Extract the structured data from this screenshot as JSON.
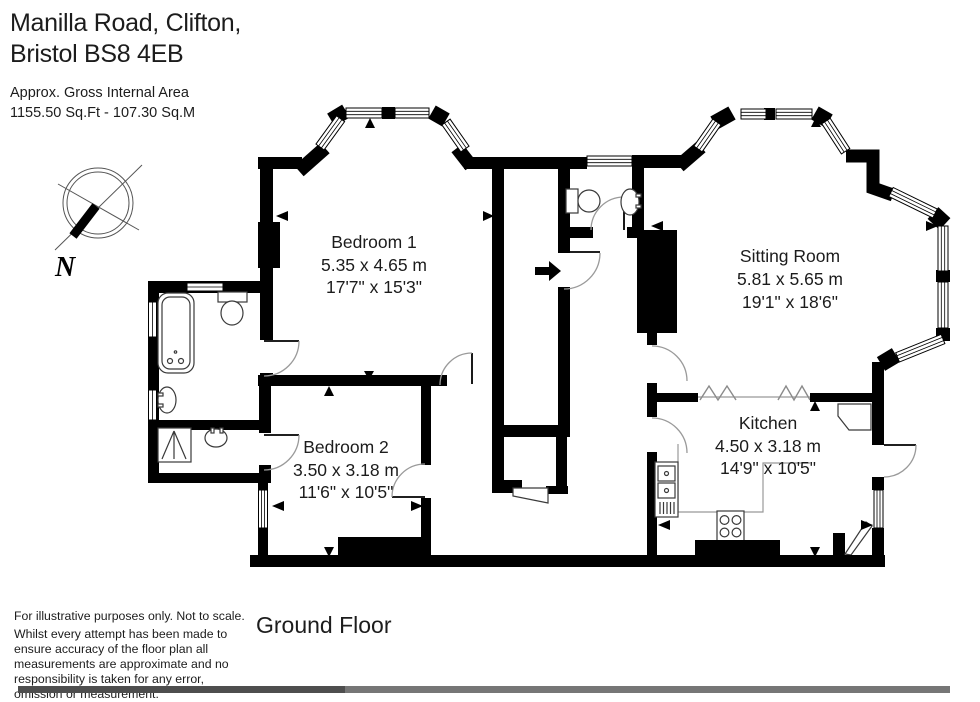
{
  "header": {
    "address_line1": "Manilla Road, Clifton,",
    "address_line2": "Bristol BS8 4EB",
    "area_label": "Approx. Gross Internal Area",
    "area_value": "1155.50 Sq.Ft - 107.30 Sq.M"
  },
  "compass": {
    "north_label": "N"
  },
  "rooms": {
    "bedroom1": {
      "name": "Bedroom 1",
      "metric": "5.35 x 4.65 m",
      "imperial": "17'7\" x 15'3\""
    },
    "bedroom2": {
      "name": "Bedroom 2",
      "metric": "3.50 x 3.18 m",
      "imperial": "11'6\" x 10'5\""
    },
    "sitting_room": {
      "name": "Sitting Room",
      "metric": "5.81 x 5.65 m",
      "imperial": "19'1\" x 18'6\""
    },
    "kitchen": {
      "name": "Kitchen",
      "metric": "4.50 x 3.18 m",
      "imperial": "14'9\" x 10'5\""
    }
  },
  "footer": {
    "floor_label": "Ground Floor",
    "disclaimer_line1": "For illustrative purposes only. Not to scale.",
    "disclaimer_line2": "Whilst every attempt has been made to ensure accuracy of the floor plan all measurements are approximate and no responsibility is taken for any error, omission or measurement."
  }
}
